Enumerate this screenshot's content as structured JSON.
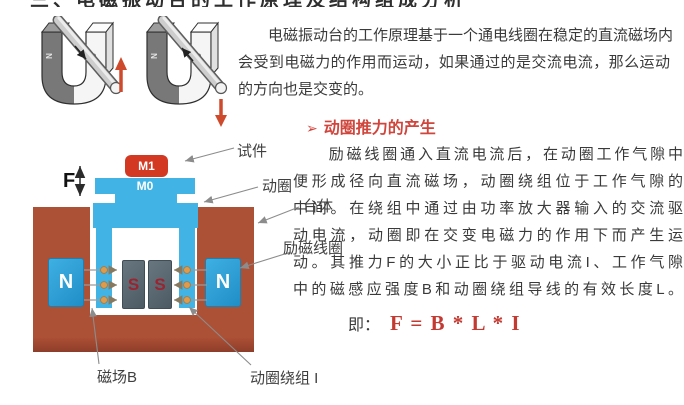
{
  "colors": {
    "accent_red": "#d0453c",
    "formula_red": "#c23a32",
    "coil_blue": "#41b4e5",
    "body_brown": "#ac5036",
    "n_pole_blue": "#2d9fd6",
    "s_pole_slate": "#5b6a74",
    "specimen_red": "#d23822",
    "text": "#3a3a3a"
  },
  "clipped_title": {
    "text": "三、电磁振动台的工作原理及结构组成分析"
  },
  "magnets": {
    "pole_n": "N",
    "pole_s": "S"
  },
  "intro": {
    "lines": [
      "　　电磁振动台的工作原理基于一个通电线圈在稳定的直流磁场内",
      "会受到电磁力的作用而运动，如果通过的是交流电流，那么运动",
      "的方向也是交变的。"
    ]
  },
  "diagram": {
    "m1": "M1",
    "m0": "M0",
    "force": "F",
    "n": "N",
    "s": "S",
    "labels": {
      "specimen": "试件",
      "moving_coil": "动圈",
      "table_body": "台体",
      "excitation_coil": "励磁线圈",
      "field_b": "磁场B",
      "coil_winding": "动圈绕组 I"
    }
  },
  "thrust": {
    "bullet": "➢",
    "heading": "动圈推力的产生",
    "lines": [
      "　　励磁线圈通入直流电流后，在动圈工作气隙中",
      "便形成径向直流磁场，动圈绕组位于工作气隙的",
      "中间。在绕组中通过由功率放大器输入的交流驱",
      "动电流，动圈即在交变电磁力的作用下而产生运",
      "动。其推力F的大小正比于驱动电流I、工作气隙",
      "中的磁感应强度B和动圈绕组导线的有效长度L。"
    ],
    "formula_prefix": "即：",
    "formula": "F = B * L * I"
  }
}
